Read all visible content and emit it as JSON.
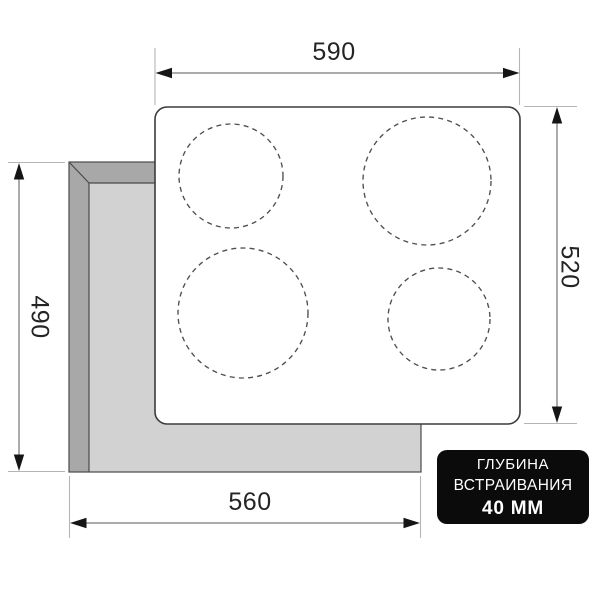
{
  "diagram": {
    "dimensions": {
      "top_width": "590",
      "right_height": "520",
      "left_cutout_height": "490",
      "bottom_cutout_width": "560"
    },
    "badge": {
      "line1": "ГЛУБИНА",
      "line2": "ВСТРАИВАНИЯ",
      "line3": "40 ММ"
    },
    "burners": [
      "burner-top-left-small",
      "burner-top-right-large",
      "burner-bottom-left-large",
      "burner-bottom-right-small"
    ]
  },
  "colors": {
    "page_bg": "#ffffff",
    "cutout_face": "#d2d2d2",
    "cutout_bevel": "#a8a8a8",
    "outline": "#4a4a4a",
    "cooktop_face": "#ffffff",
    "cooktop_border": "#3c3c3c",
    "circle_dash": "#4f4f4f",
    "ext_line": "#b5b5b5",
    "dim_line": "#8f8f8f",
    "arrow": "#151515",
    "dim_text": "#242424",
    "badge_bg": "#0b0b0b",
    "badge_text": "#ffffff"
  }
}
